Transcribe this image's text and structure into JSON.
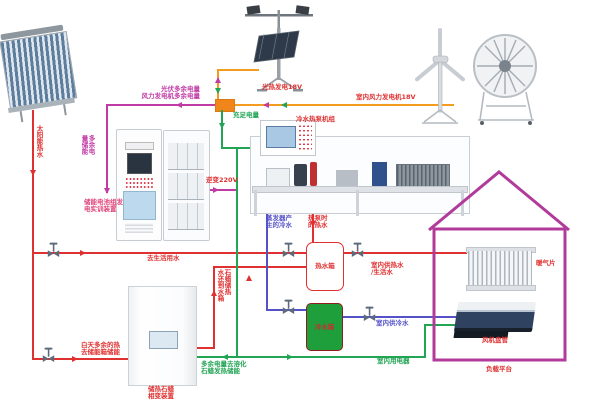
{
  "labels": {
    "solar_hot_water": "太阳能热水",
    "pv_surplus": "光伏多余电量",
    "wind_surplus": "风力发电机多余电量",
    "surplus_to_storage": "多余电\n量储能",
    "battery_device": "储能电池组发\n电实训装置",
    "inverter_220v": "逆变220V",
    "sufficient_power": "充足电量",
    "pv_generation": "光热发电18V",
    "indoor_wind_generator": "室内风力发电机18V",
    "chiller_heat_pump_unit": "冷水热泵机组",
    "evaporator_cold_water": "蒸发器产\n生的冷水",
    "heat_pump_hot_water": "热泵时\n的热水",
    "to_domestic_water": "去生活用水",
    "daytime_surplus_heat": "白天多余的热\n去储能箱储能",
    "paraffin_heat_return": "石蜡储热\n水还到水箱",
    "surplus_melt_paraffin": "多余电量去溶化\n石蜡发热储能",
    "paraffin_device": "储热石蜡\n相变装置",
    "hot_water_tank": "热水箱",
    "cold_water_tank": "冷水箱",
    "indoor_hot_water": "室内供热水\n/生活水",
    "indoor_cold_water": "室内供冷水",
    "indoor_appliances": "室内用电器",
    "radiator": "暖气片",
    "fan_coil": "风机盘管",
    "load_platform": "负载平台"
  },
  "colors": {
    "hot_water_line": "#e03131",
    "cold_water_line": "#5552c8",
    "surplus_power_line": "#c03ba4",
    "main_power_line": "#f39c1f",
    "supply_power_line": "#21a453",
    "house_outline": "#b13a9b"
  }
}
